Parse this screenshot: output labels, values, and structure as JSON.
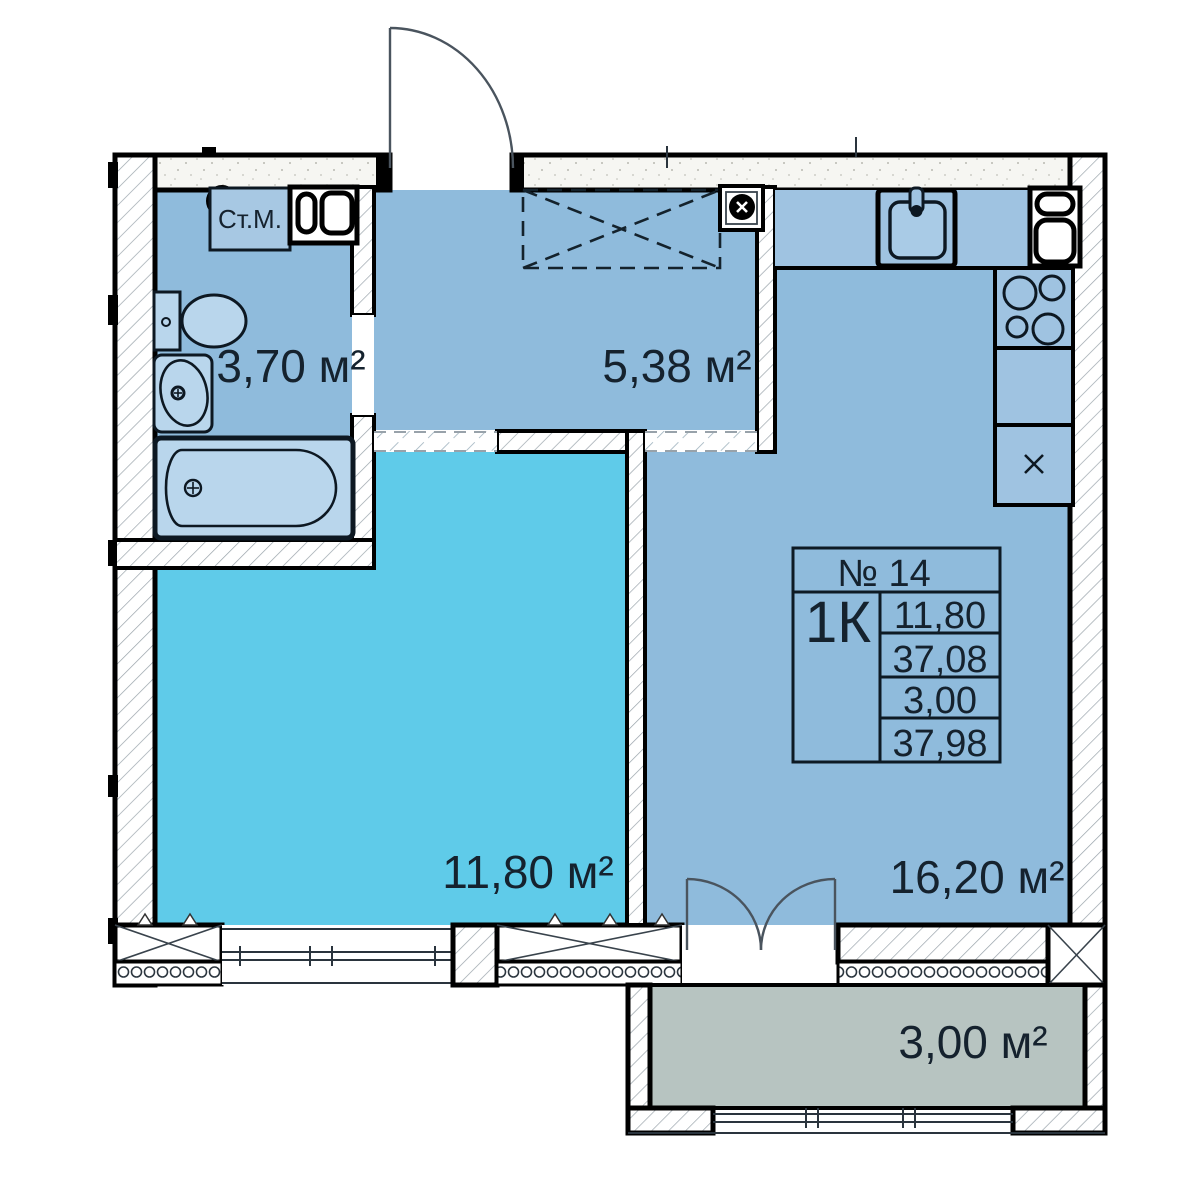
{
  "plan": {
    "info_table": {
      "number_label": "№ 14",
      "type_label": "1К",
      "rows": [
        "11,80",
        "37,08",
        "3,00",
        "37,98"
      ]
    },
    "labels": {
      "bathroom_area": "3,70 м²",
      "hallway_area": "5,38 м²",
      "living_area": "11,80 м²",
      "kitchen_area": "16,20 м²",
      "balcony_area": "3,00 м²",
      "washing_machine": "Ст.М."
    },
    "colors": {
      "room_blue": "#8fbbdc",
      "living_cyan": "#5fcbe9",
      "balcony_gray": "#b7c4c1",
      "fixture_blue": "#b9d6ec",
      "ink": "#15222e"
    }
  }
}
